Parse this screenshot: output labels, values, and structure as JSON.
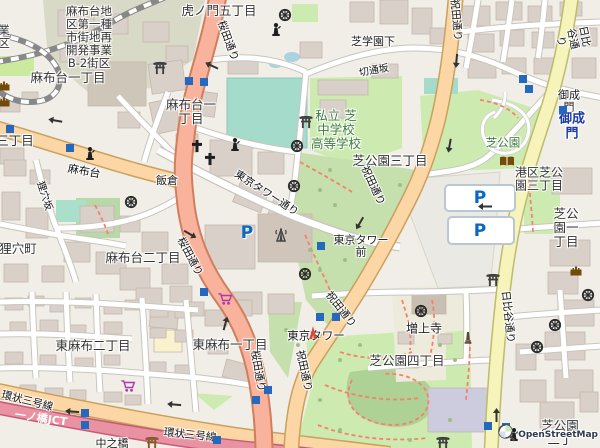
{
  "attribution": {
    "brand": "OpenStreetMap"
  },
  "colors": {
    "background": "#f1eee8",
    "building": "#d9d0c9",
    "building_outline": "#c3b8aa",
    "construction_zone": "#d9d9c7",
    "road_trunk": "#f9b29c",
    "road_trunk_casing": "#cf7f5d",
    "road_primary": "#fcd6a4",
    "road_primary_casing": "#c9a15e",
    "road_secondary": "#f6f4bb",
    "road_secondary_casing": "#bcbc6c",
    "road_motorway": "#e892a2",
    "road_motorway_casing": "#c75b77",
    "road_minor": "#ffffff",
    "road_minor_casing": "#c9c5bd",
    "park": "#cdebb0",
    "scrub": "#c5dfad",
    "pitch": "#a5dbca",
    "water": "#aad3df",
    "wood": "#aed196",
    "path_red": "#f7806c",
    "rail": "#888888",
    "parking_area": "#ebe9e4",
    "parking_p": "#0968c3",
    "subway_marker": "#2569be",
    "label": "#333333",
    "road_label": "#111111",
    "green_label": "#3e7c3e",
    "station_label": "#1b3aa5",
    "poi_brown": "#734a08",
    "poi_purple": "#ac39ac",
    "tower_red": "#db4a36"
  },
  "labels": [
    {
      "text": "虎ノ門五丁目",
      "x": 219,
      "y": 11,
      "size": 12.5,
      "kind": "place"
    },
    {
      "text": "麻布台地\n区第一種\n市街地再\n開発事業\nB-2街区",
      "x": 89,
      "y": 37,
      "size": 11.5,
      "kind": "place"
    },
    {
      "text": "麻布台一丁目",
      "x": 68,
      "y": 78,
      "size": 12.5,
      "kind": "place"
    },
    {
      "text": "麻布台一\n丁目",
      "x": 191,
      "y": 112,
      "size": 12.5,
      "kind": "place"
    },
    {
      "text": "三丁目",
      "x": 15,
      "y": 141,
      "size": 12.5,
      "kind": "place"
    },
    {
      "text": "狸穴町",
      "x": 18,
      "y": 249,
      "size": 12.5,
      "kind": "place"
    },
    {
      "text": "麻布台二丁目",
      "x": 143,
      "y": 258,
      "size": 12.5,
      "kind": "place"
    },
    {
      "text": "芝公園三丁目",
      "x": 390,
      "y": 161,
      "size": 12.5,
      "kind": "place"
    },
    {
      "text": "港区芝公\n園三丁目",
      "x": 539,
      "y": 180,
      "size": 12,
      "kind": "place"
    },
    {
      "text": "芝公園一丁目",
      "x": 566,
      "y": 228,
      "size": 12.5,
      "kind": "place"
    },
    {
      "text": "芝公園四丁目",
      "x": 407,
      "y": 361,
      "size": 12.5,
      "kind": "place"
    },
    {
      "text": "東麻布二丁目",
      "x": 93,
      "y": 346,
      "size": 12.5,
      "kind": "place"
    },
    {
      "text": "東麻布一丁目",
      "x": 230,
      "y": 345,
      "size": 12.5,
      "kind": "place"
    },
    {
      "text": "芝公園二丁",
      "x": 560,
      "y": 433,
      "size": 12.5,
      "kind": "place"
    },
    {
      "text": "業\n区",
      "x": 4,
      "y": 37,
      "size": 11.5,
      "kind": "place"
    },
    {
      "text": "桜田通り",
      "x": 227,
      "y": 41,
      "rot": 70,
      "kind": "road"
    },
    {
      "text": "桜田通り",
      "x": 189,
      "y": 257,
      "rot": 62,
      "kind": "road"
    },
    {
      "text": "桜田通り",
      "x": 257,
      "y": 371,
      "rot": 80,
      "kind": "road"
    },
    {
      "text": "祝田通り",
      "x": 455,
      "y": 20,
      "rot": 85,
      "kind": "road"
    },
    {
      "text": "祝田通り",
      "x": 372,
      "y": 186,
      "rot": 65,
      "kind": "road"
    },
    {
      "text": "祝田通り",
      "x": 340,
      "y": 310,
      "rot": 52,
      "kind": "road"
    },
    {
      "text": "祝田通り",
      "x": 303,
      "y": 371,
      "rot": 78,
      "kind": "road"
    },
    {
      "text": "日比谷通り",
      "x": 572,
      "y": 39,
      "rot": 78,
      "kind": "road"
    },
    {
      "text": "日比谷通り",
      "x": 507,
      "y": 317,
      "rot": 84,
      "kind": "road"
    },
    {
      "text": "麻布台",
      "x": 84,
      "y": 172,
      "rot": 10,
      "size": 11,
      "kind": "road"
    },
    {
      "text": "狸穴坂",
      "x": 44,
      "y": 196,
      "rot": 72,
      "size": 10,
      "kind": "road"
    },
    {
      "text": "切通坂",
      "x": 374,
      "y": 71,
      "rot": -10,
      "size": 10,
      "kind": "road"
    },
    {
      "text": "東京タワー通り",
      "x": 266,
      "y": 194,
      "rot": 33,
      "kind": "road"
    },
    {
      "text": "環状三号線",
      "x": 27,
      "y": 402,
      "rot": 14,
      "kind": "road"
    },
    {
      "text": "環状三号線",
      "x": 190,
      "y": 436,
      "rot": 6,
      "kind": "road"
    },
    {
      "text": "一ノ橋JCT",
      "x": 41,
      "y": 419,
      "rot": 8,
      "size": 11,
      "kind": "road-white"
    },
    {
      "text": "飯倉",
      "x": 167,
      "y": 181,
      "size": 11,
      "kind": "poi"
    },
    {
      "text": "芝学園下",
      "x": 373,
      "y": 42,
      "size": 11,
      "kind": "poi"
    },
    {
      "text": "御成門",
      "x": 569,
      "y": 102,
      "size": 11,
      "kind": "poi"
    },
    {
      "text": "東京タワー\n前",
      "x": 361,
      "y": 247,
      "size": 11,
      "kind": "poi"
    },
    {
      "text": "中之橋",
      "x": 112,
      "y": 444,
      "size": 11,
      "kind": "poi"
    },
    {
      "text": "増上寺",
      "x": 424,
      "y": 329,
      "size": 12,
      "kind": "poi"
    },
    {
      "text": "東京タワー",
      "x": 316,
      "y": 336,
      "size": 11.5,
      "kind": "poi"
    },
    {
      "text": "私立 芝\n中学校\n高等学校",
      "x": 336,
      "y": 130,
      "size": 12.5,
      "kind": "green"
    },
    {
      "text": "芝公園",
      "x": 503,
      "y": 143,
      "size": 11.5,
      "kind": "green"
    },
    {
      "text": "御成門",
      "x": 572,
      "y": 127,
      "size": 13,
      "kind": "station"
    }
  ],
  "icons": [
    {
      "name": "shinto-shrine-icon",
      "type": "torii",
      "x": 160,
      "y": 69,
      "c": "#404040"
    },
    {
      "name": "shinto-shrine-icon",
      "type": "torii",
      "x": 306,
      "y": 123,
      "c": "#404040"
    },
    {
      "name": "shinto-shrine-icon",
      "type": "torii",
      "x": 493,
      "y": 281,
      "c": "#404040"
    },
    {
      "name": "shinto-shrine-icon",
      "type": "torii",
      "x": 443,
      "y": 444,
      "c": "#404040"
    },
    {
      "name": "shinto-shrine-icon",
      "type": "torii",
      "x": 152,
      "y": 444,
      "c": "#8a5a2a"
    },
    {
      "name": "buddhist-temple-icon",
      "type": "wheel",
      "x": 285,
      "y": 16,
      "c": "#2b2b2b"
    },
    {
      "name": "buddhist-temple-icon",
      "type": "wheel",
      "x": 297,
      "y": 147,
      "c": "#2b2b2b"
    },
    {
      "name": "buddhist-temple-icon",
      "type": "wheel",
      "x": 294,
      "y": 187,
      "c": "#2b2b2b"
    },
    {
      "name": "buddhist-temple-icon",
      "type": "wheel",
      "x": 305,
      "y": 275,
      "c": "#2b2b2b"
    },
    {
      "name": "buddhist-temple-icon",
      "type": "wheel",
      "x": 131,
      "y": 203,
      "c": "#2b2b2b"
    },
    {
      "name": "buddhist-temple-icon",
      "type": "wheel",
      "x": 421,
      "y": 312,
      "c": "#2b2b2b"
    },
    {
      "name": "buddhist-temple-icon",
      "type": "wheel",
      "x": 588,
      "y": 296,
      "c": "#2b2b2b"
    },
    {
      "name": "buddhist-temple-icon",
      "type": "wheel",
      "x": 555,
      "y": 326,
      "c": "#2b2b2b"
    },
    {
      "name": "buddhist-temple-icon",
      "type": "wheel",
      "x": 537,
      "y": 348,
      "c": "#2b2b2b"
    },
    {
      "name": "church-icon",
      "type": "cross",
      "x": 197,
      "y": 147,
      "c": "#1f1f1f"
    },
    {
      "name": "church-icon",
      "type": "cross",
      "x": 210,
      "y": 160,
      "c": "#1f1f1f"
    },
    {
      "name": "statue-icon",
      "type": "statue",
      "x": 276,
      "y": 31,
      "c": "#1f1f1f"
    },
    {
      "name": "statue-icon",
      "type": "statue",
      "x": 235,
      "y": 146,
      "c": "#1f1f1f"
    },
    {
      "name": "statue-icon",
      "type": "statue",
      "x": 90,
      "y": 155,
      "c": "#1f1f1f"
    },
    {
      "name": "statue-icon",
      "type": "statue",
      "x": 514,
      "y": 436,
      "c": "#1f1f1f"
    },
    {
      "name": "communications-tower-icon",
      "type": "commtower",
      "x": 281,
      "y": 237,
      "c": "#444444"
    },
    {
      "name": "tokyo-tower-icon",
      "type": "tokyotower",
      "x": 313,
      "y": 334,
      "c": "#db4a36"
    },
    {
      "name": "library-icon",
      "type": "book",
      "x": 507,
      "y": 162,
      "c": "#734a08"
    },
    {
      "name": "castle-icon",
      "type": "castle",
      "x": 4,
      "y": 86,
      "c": "#734a08"
    },
    {
      "name": "castle-icon",
      "type": "castle",
      "x": 4,
      "y": 102,
      "c": "#734a08"
    },
    {
      "name": "castle-icon",
      "type": "castle",
      "x": 576,
      "y": 271,
      "c": "#734a08"
    },
    {
      "name": "monument-icon",
      "type": "obelisk",
      "x": 468,
      "y": 339,
      "c": "#5a4632"
    },
    {
      "name": "supermarket-icon",
      "type": "cart",
      "x": 128,
      "y": 387,
      "c": "#ac39ac"
    },
    {
      "name": "supermarket-icon",
      "type": "cart",
      "x": 225,
      "y": 300,
      "c": "#ac39ac"
    },
    {
      "name": "parking-icon",
      "type": "parking",
      "x": 247,
      "y": 233,
      "label": "P"
    },
    {
      "name": "parking-icon",
      "type": "parking",
      "x": 480,
      "y": 198,
      "label": "P"
    },
    {
      "name": "parking-icon",
      "type": "parking",
      "x": 480,
      "y": 231,
      "label": "P"
    },
    {
      "name": "subway-entrance-icon",
      "type": "subway",
      "x": 189,
      "y": 81
    },
    {
      "name": "subway-entrance-icon",
      "type": "subway",
      "x": 204,
      "y": 82
    },
    {
      "name": "subway-entrance-icon",
      "type": "subway",
      "x": 10,
      "y": 129
    },
    {
      "name": "subway-entrance-icon",
      "type": "subway",
      "x": 70,
      "y": 148
    },
    {
      "name": "subway-entrance-icon",
      "type": "subway",
      "x": 523,
      "y": 79
    },
    {
      "name": "subway-entrance-icon",
      "type": "subway",
      "x": 529,
      "y": 89
    },
    {
      "name": "subway-entrance-icon",
      "type": "subway",
      "x": 563,
      "y": 110
    },
    {
      "name": "subway-entrance-icon",
      "type": "subway",
      "x": 321,
      "y": 246
    },
    {
      "name": "subway-entrance-icon",
      "type": "subway",
      "x": 320,
      "y": 317
    },
    {
      "name": "subway-entrance-icon",
      "type": "subway",
      "x": 336,
      "y": 317
    },
    {
      "name": "subway-entrance-icon",
      "type": "subway",
      "x": 488,
      "y": 426
    },
    {
      "name": "subway-entrance-icon",
      "type": "subway",
      "x": 506,
      "y": 427
    },
    {
      "name": "subway-entrance-icon",
      "type": "subway",
      "x": 85,
      "y": 413
    },
    {
      "name": "subway-entrance-icon",
      "type": "subway",
      "x": 85,
      "y": 425
    },
    {
      "name": "subway-entrance-icon",
      "type": "subway",
      "x": 256,
      "y": 400
    },
    {
      "name": "subway-entrance-icon",
      "type": "subway",
      "x": 268,
      "y": 390
    },
    {
      "name": "subway-entrance-icon",
      "type": "subway",
      "x": 217,
      "y": 440
    },
    {
      "name": "subway-entrance-icon",
      "type": "subway",
      "x": 204,
      "y": 292
    },
    {
      "name": "oneway-arrow-icon",
      "type": "arrow",
      "x": 211,
      "y": 67,
      "rot": 205
    },
    {
      "name": "oneway-arrow-icon",
      "type": "arrow",
      "x": 55,
      "y": 122,
      "rot": 190
    },
    {
      "name": "oneway-arrow-icon",
      "type": "arrow",
      "x": 458,
      "y": 61,
      "rot": 95
    },
    {
      "name": "oneway-arrow-icon",
      "type": "arrow",
      "x": 361,
      "y": 224,
      "rot": 120
    },
    {
      "name": "oneway-arrow-icon",
      "type": "arrow",
      "x": 495,
      "y": 415,
      "rot": 270
    },
    {
      "name": "oneway-arrow-icon",
      "type": "arrow",
      "x": 224,
      "y": 323,
      "rot": 285
    },
    {
      "name": "oneway-arrow-icon",
      "type": "arrow",
      "x": 191,
      "y": 233,
      "rot": 30
    },
    {
      "name": "oneway-arrow-icon",
      "type": "arrow",
      "x": 72,
      "y": 413,
      "rot": 185
    },
    {
      "name": "oneway-arrow-icon",
      "type": "arrow",
      "x": 174,
      "y": 406,
      "rot": 185
    },
    {
      "name": "oneway-arrow-icon",
      "type": "arrow",
      "x": 485,
      "y": 208,
      "rot": 180
    },
    {
      "name": "oneway-arrow-icon",
      "type": "arrow",
      "x": 451,
      "y": 146,
      "rot": 100
    }
  ]
}
